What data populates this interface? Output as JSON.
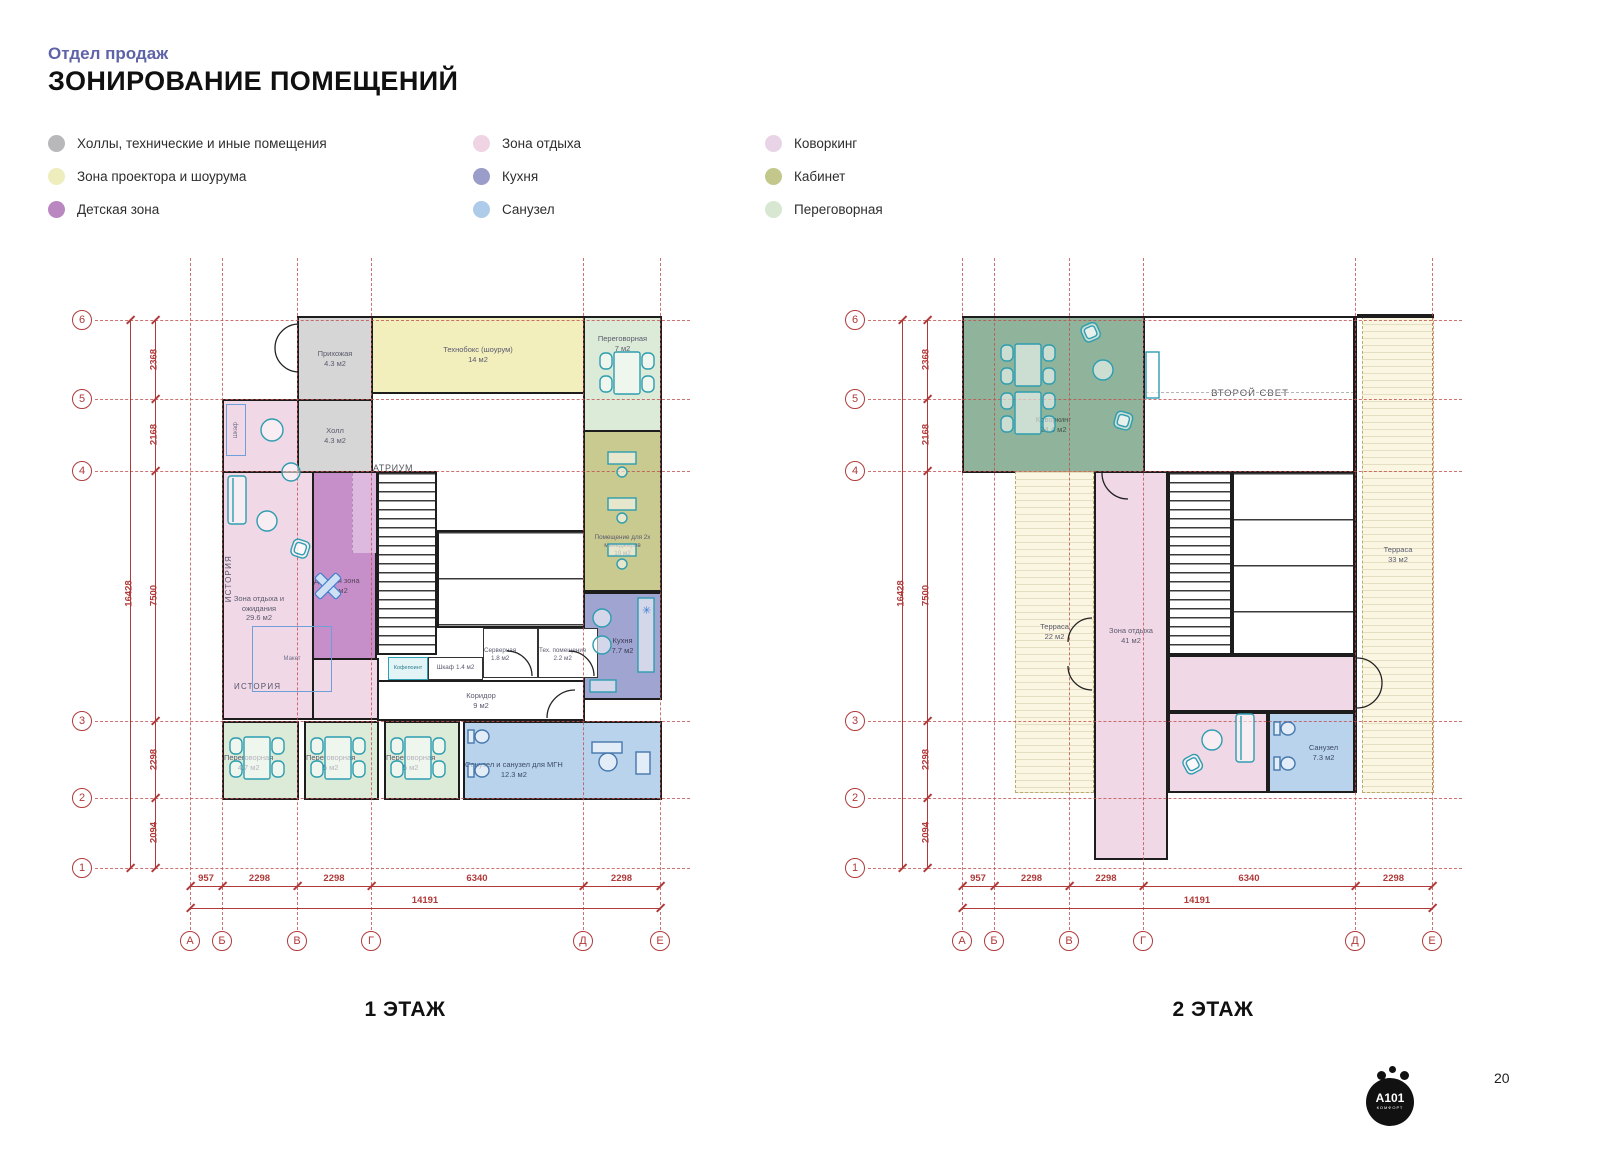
{
  "header": {
    "subtitle": "Отдел продаж",
    "title": "ЗОНИРОВАНИЕ ПОМЕЩЕНИЙ"
  },
  "legend": {
    "items": [
      {
        "label": "Холлы, технические и иные помещения",
        "color": "#b8b8bb"
      },
      {
        "label": "Зона проектора и шоурума",
        "color": "#eeedbe"
      },
      {
        "label": "Детская зона",
        "color": "#bb87c0"
      },
      {
        "label": "Зона отдыха",
        "color": "#f0d4e4"
      },
      {
        "label": "Кухня",
        "color": "#9a9cc9"
      },
      {
        "label": "Санузел",
        "color": "#aecbe9"
      },
      {
        "label": "Коворкинг",
        "color": "#e8d4e6"
      },
      {
        "label": "Кабинет",
        "color": "#c3c78c"
      },
      {
        "label": "Переговорная",
        "color": "#d7e7d2"
      }
    ]
  },
  "grid": {
    "rows": [
      "6",
      "5",
      "4",
      "3",
      "2",
      "1"
    ],
    "cols": [
      "А",
      "Б",
      "В",
      "Г",
      "Д",
      "Е"
    ],
    "dims_v": [
      "2368",
      "2168",
      "7500",
      "2298",
      "2094"
    ],
    "total_v": "16428",
    "dims_h": [
      "957",
      "2298",
      "2298",
      "6340",
      "2298"
    ],
    "total_h": "14191"
  },
  "floor1": {
    "caption": "1 ЭТАЖ",
    "rooms": {
      "prihozhaya": {
        "name": "Прихожая",
        "area": "4.3 м2"
      },
      "tehnoboks": {
        "name": "Технобокс (шоурум)",
        "area": "14 м2"
      },
      "pereg7": {
        "name": "Переговорная",
        "area": "7 м2"
      },
      "holl": {
        "name": "Холл",
        "area": "4.3 м2"
      },
      "atrium": {
        "name": "АТРИУМ",
        "area": "50 м2"
      },
      "zona": {
        "name": "Зона отдыха и ожидания",
        "area": "29.6 м2"
      },
      "detskaya": {
        "name": "Детская зона",
        "area": "8.2 м2"
      },
      "managery": {
        "name": "Помещение для 2х менеджеров",
        "area": "10 м2"
      },
      "kuhnya": {
        "name": "Кухня",
        "area": "7.7 м2"
      },
      "servernaya": {
        "name": "Серверная",
        "area": "1.8 м2"
      },
      "teh": {
        "name": "Тех. помещение",
        "area": "2.2 м2"
      },
      "shkaf14": {
        "name": "Шкаф",
        "area": "1.4 м2"
      },
      "kofepoint": {
        "name": "Кофепоинт"
      },
      "koridor": {
        "name": "Коридор",
        "area": "9 м2"
      },
      "pereg47": {
        "name": "Переговорная",
        "area": "4.7 м2"
      },
      "pereg5a": {
        "name": "Переговорная",
        "area": "5 м2"
      },
      "pereg5b": {
        "name": "Переговорная",
        "area": "5 м2"
      },
      "mgn": {
        "name": "Санузел и санузел для МГН",
        "area": "12.3 м2"
      },
      "istoriya": "ИСТОРИЯ",
      "istoriya_v": "ИСТОРИЯ",
      "maket": "Макет",
      "shkaf_v": "Шкаф"
    }
  },
  "floor2": {
    "caption": "2 ЭТАЖ",
    "rooms": {
      "kovorking": {
        "name": "Коворкинг",
        "area": "24.4 м2"
      },
      "vtoroy": {
        "name": "ВТОРОЙ СВЕТ"
      },
      "terrasa33": {
        "name": "Терраса",
        "area": "33 м2"
      },
      "terrasa22": {
        "name": "Терраса",
        "area": "22 м2"
      },
      "zona": {
        "name": "Зона отдыха",
        "area": "41 м2"
      },
      "sanuzel": {
        "name": "Санузел",
        "area": "7.3 м2"
      }
    }
  },
  "icons": {
    "vent": "✳"
  },
  "footer": {
    "page": "20",
    "logo": "А101",
    "logo_sub": "КОМФОРТ"
  }
}
